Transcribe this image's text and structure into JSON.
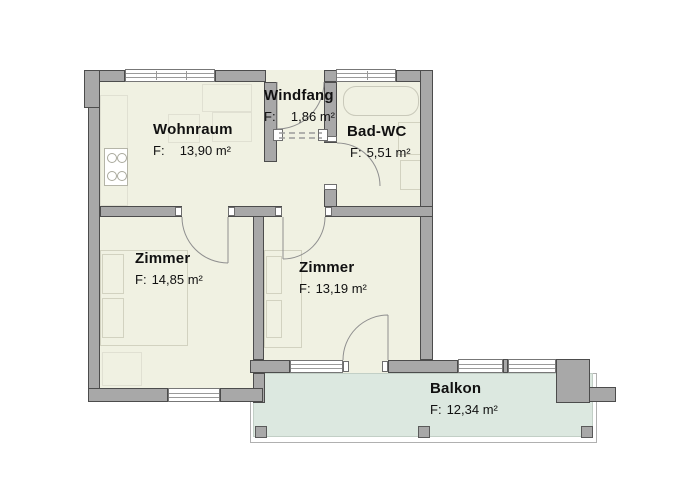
{
  "title": "Wohnung Grundriss",
  "colors": {
    "floor": "#f0f1e2",
    "wall": "#a8a8a8",
    "wall_outline": "#4c4c4c",
    "balcony": "#dce8e0",
    "text": "#111111"
  },
  "rooms": [
    {
      "id": "wohnraum",
      "name": "Wohnraum",
      "area_prefix": "F:",
      "area": "13,90 m²"
    },
    {
      "id": "windfang",
      "name": "Windfang",
      "area_prefix": "F:",
      "area": "1,86 m²"
    },
    {
      "id": "bad-wc",
      "name": "Bad-WC",
      "area_prefix": "F:",
      "area": "5,51 m²"
    },
    {
      "id": "zimmer-1",
      "name": "Zimmer",
      "area_prefix": "F:",
      "area": "14,85 m²"
    },
    {
      "id": "zimmer-2",
      "name": "Zimmer",
      "area_prefix": "F:",
      "area": "13,19 m²"
    },
    {
      "id": "balkon",
      "name": "Balkon",
      "area_prefix": "F:",
      "area": "12,34 m²"
    }
  ]
}
